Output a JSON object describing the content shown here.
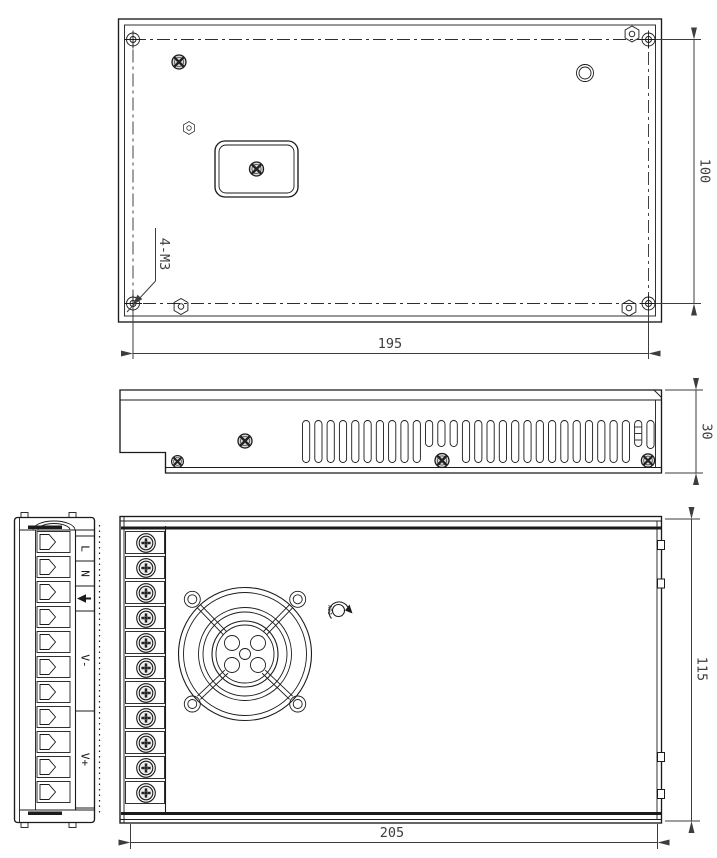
{
  "meta": {
    "title": "Power supply enclosure dimensional drawing"
  },
  "dimensions": {
    "mounting_width": "195",
    "mounting_height": "100",
    "side_height": "30",
    "front_height": "115",
    "front_width": "205",
    "mounting_hole_note": "4-M3"
  },
  "terminals": {
    "line": "L",
    "neutral": "N",
    "ground_symbol": "earth-arrow",
    "v_minus": "V-",
    "v_plus": "V+"
  },
  "adjust": {
    "label": "ADJ"
  },
  "colors": {
    "line": "#1b1b1b",
    "dim_text": "#3d3d3d",
    "background": "#ffffff"
  }
}
